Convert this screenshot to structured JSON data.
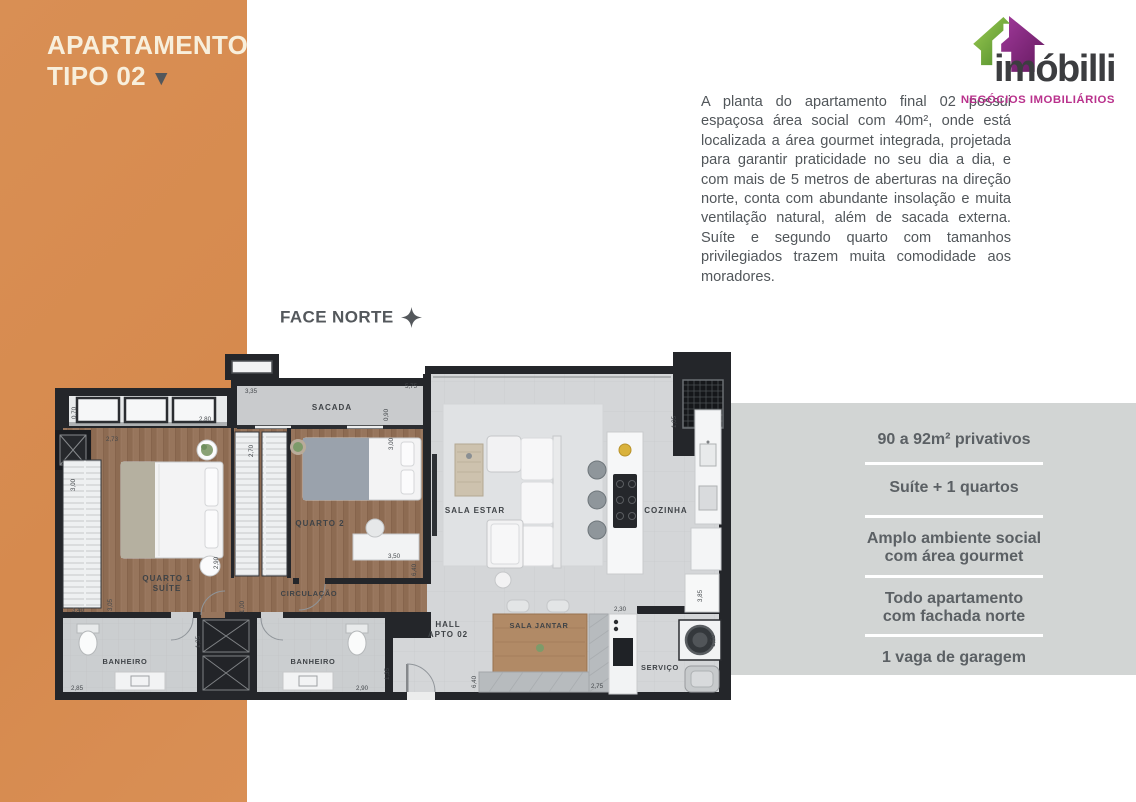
{
  "left_panel": {
    "title_line1": "APARTAMENTO",
    "title_line2": "TIPO 02"
  },
  "icons": {
    "title_arrow": "▼"
  },
  "logo": {
    "brand": "imóbilli",
    "tagline": "NEGÓCIOS IMOBILIÁRIOS"
  },
  "description": "A planta do apartamento final 02 possui espaçosa área social com 40m², onde está localizada a área gourmet integrada, projetada para garantir praticidade no seu dia a dia, e  com mais de 5 metros de aberturas na direção norte, conta com abundante insolação e muita ventilação natural, além de sacada externa. Suíte e segundo quarto com tamanhos privilegiados trazem muita comodidade aos moradores.",
  "compass": {
    "label": "FACE NORTE"
  },
  "plan": {
    "labels": {
      "sacada": "SACADA",
      "quarto1_l1": "QUARTO 1",
      "quarto1_l2": "SUÍTE",
      "quarto2": "QUARTO 2",
      "circulacao": "CIRCULAÇÃO",
      "banheiro1": "BANHEIRO",
      "banheiro2": "BANHEIRO",
      "sala_estar": "SALA ESTAR",
      "cozinha": "COZINHA",
      "hall_l1": "HALL",
      "hall_l2": "APTO 02",
      "sala_jantar": "SALA JANTAR",
      "servico": "SERVIÇO"
    },
    "dims": {
      "sacada_w": "3,35",
      "janela_h": "0,70",
      "suite_top": "2,80",
      "suite_w": "2,73",
      "closet_h": "3,00",
      "suite_h1": "2,90",
      "suite_left": "3,40",
      "suite_h2": "3,05",
      "closet2_h": "2,70",
      "circ_w": "1,00",
      "sala_top": "5,75",
      "sala_h1": "0,90",
      "sala_h2": "3,00",
      "q2_w": "3,50",
      "q2_h": "6,40",
      "elev_h": "1,05",
      "ban1_w": "2,85",
      "ban1_h": "1,35",
      "ban2_h": "1,35",
      "ban2_w": "2,90",
      "hall_h": "6,40",
      "jantar_w": "2,30",
      "jantar_w2": "2,75",
      "serv_h": "3,85",
      "wash_h": "1,50"
    }
  },
  "features": [
    {
      "line1": "90 a 92m² privativos",
      "line2": ""
    },
    {
      "line1": "Suíte + 1 quartos",
      "line2": ""
    },
    {
      "line1": "Amplo ambiente social",
      "line2": "com área gourmet"
    },
    {
      "line1": "Todo apartamento",
      "line2": "com fachada norte"
    },
    {
      "line1": "1 vaga de garagem",
      "line2": ""
    }
  ],
  "colors": {
    "orange": "#d78e53",
    "cream": "#f8efdc",
    "panel_gray": "#d2d5d4",
    "magenta": "#b9318c",
    "logo_green": "#7ab648",
    "logo_purple": "#8e2c8a"
  }
}
